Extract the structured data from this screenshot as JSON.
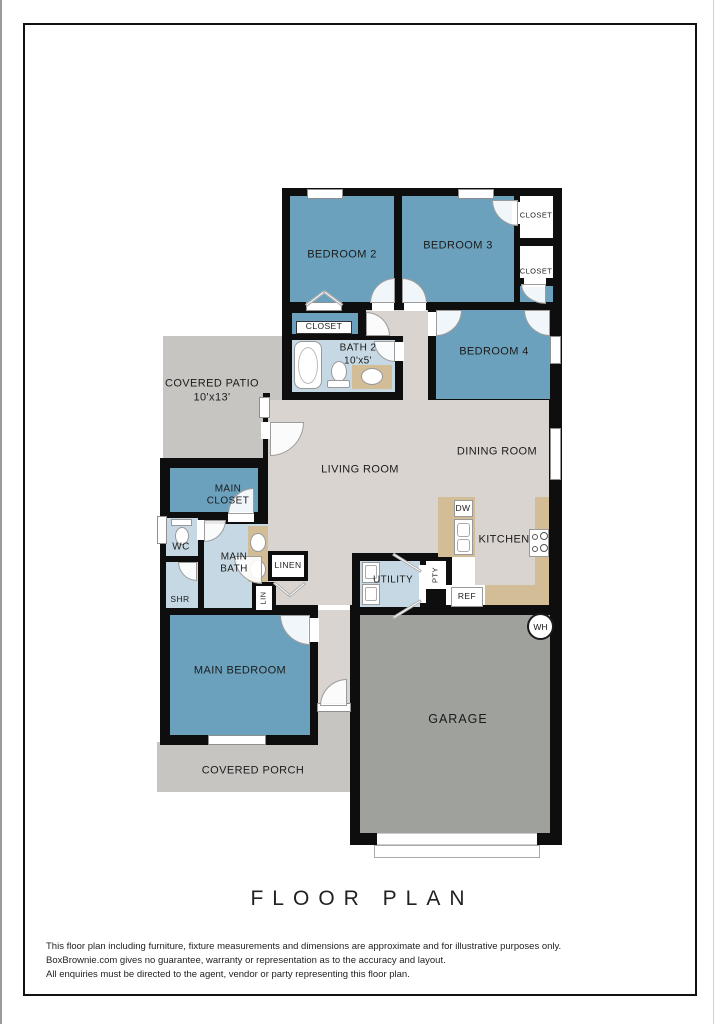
{
  "title": "FLOOR PLAN",
  "plan": {
    "rooms": {
      "bedroom2": "BEDROOM 2",
      "bedroom3": "BEDROOM 3",
      "bedroom4": "BEDROOM 4",
      "closet_top_right": "CLOSET",
      "closet_mid_right": "CLOSET",
      "closet_bed2": "CLOSET",
      "bath2": "BATH 2",
      "bath2_dim": "10'x5'",
      "covered_patio": "COVERED PATIO",
      "patio_dim": "10'x13'",
      "living_room": "LIVING ROOM",
      "dining_room": "DINING ROOM",
      "main_closet": "MAIN\nCLOSET",
      "wc": "WC",
      "main_bath": "MAIN\nBATH",
      "shr": "SHR",
      "linen": "LINEN",
      "lin": "LIN",
      "utility": "UTILITY",
      "kitchen": "KITCHEN",
      "garage": "GARAGE",
      "main_bedroom": "MAIN BEDROOM",
      "covered_porch": "COVERED PORCH"
    },
    "fixtures": {
      "dw": "DW",
      "ref": "REF",
      "pty": "PTY",
      "wh": "WH"
    }
  },
  "disclaimer": {
    "line1": "This floor plan including furniture, fixture measurements and dimensions are approximate and for illustrative purposes only.",
    "line2": "BoxBrownie.com gives no guarantee, warranty or representation as to the accuracy and layout.",
    "line3": "All enquiries must be directed to the agent, vendor or party representing this floor plan."
  },
  "colors": {
    "bedroom": "#6BA1BC",
    "bath": "#C6D8E3",
    "floor": "#D9D4D0",
    "patio": "#C7C5C1",
    "garage": "#9FA19C",
    "wall": "#0E0E0E",
    "counter": "#D2BD96"
  }
}
